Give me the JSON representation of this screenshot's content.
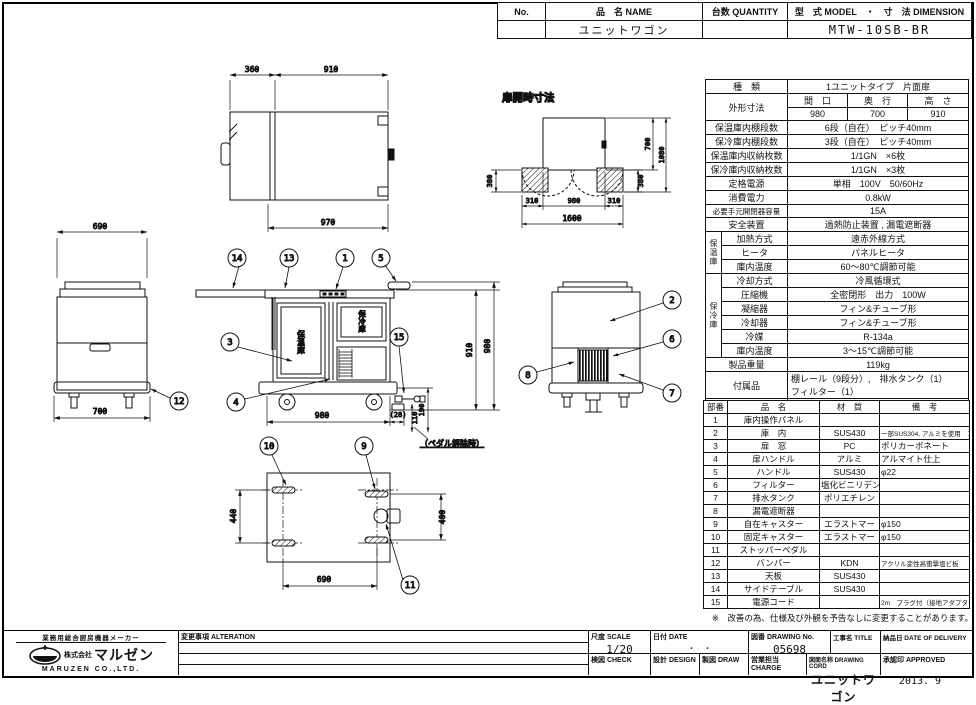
{
  "sheet": {
    "header": {
      "no_label": "No.",
      "name_label": "品　名 NAME",
      "qty_label": "台数 QUANTITY",
      "model_label": "型　式 MODEL　・　寸　法 DIMENSION",
      "name_value": "ユニットワゴン",
      "model_value": "MTW-10SB-BR"
    },
    "disclaimer": "※　改善の為、仕様及び外観を予告なしに変更することがあります。",
    "issue_date": "2013. 9"
  },
  "spec": {
    "kind_label": "種　類",
    "kind_value": "1ユニットタイプ　片面扉",
    "outer_dim_label": "外形寸法",
    "width_label": "間　口",
    "depth_label": "奥　行",
    "height_label": "高　さ",
    "width_value": "980",
    "depth_value": "700",
    "height_value": "910",
    "warm_shelf_label": "保温庫内棚段数",
    "warm_shelf_value": "6段（自在）　ピッチ40mm",
    "cold_shelf_label": "保冷庫内棚段数",
    "cold_shelf_value": "3段（自在）　ピッチ40mm",
    "warm_cap_label": "保温庫内収納枚数",
    "warm_cap_value": "1/1GN　×6枚",
    "cold_cap_label": "保冷庫内収納枚数",
    "cold_cap_value": "1/1GN　×3枚",
    "power_label": "定格電源",
    "power_value": "単相　100V　50/60Hz",
    "consumption_label": "消費電力",
    "consumption_value": "0.8kW",
    "breaker_label": "必要手元開閉器容量",
    "breaker_value": "15A",
    "safety_label": "安全装置",
    "safety_value": "過熱防止装置 , 漏電遮断器",
    "warm_group_label": "保温庫",
    "heat_method_label": "加熱方式",
    "heat_method_value": "遠赤外線方式",
    "heater_label": "ヒータ",
    "heater_value": "パネルヒータ",
    "warm_temp_label": "庫内温度",
    "warm_temp_value": "60〜80℃調節可能",
    "cold_group_label": "保冷庫",
    "cool_method_label": "冷却方式",
    "cool_method_value": "冷風循環式",
    "compressor_label": "圧縮機",
    "compressor_value": "全密閉形　出力　100W",
    "condenser_label": "凝縮器",
    "condenser_value": "フィン&チューブ形",
    "cooler_label": "冷却器",
    "cooler_value": "フィン&チューブ形",
    "refrigerant_label": "冷媒",
    "refrigerant_value": "R-134a",
    "cold_temp_label": "庫内温度",
    "cold_temp_value": "3〜15℃調節可能",
    "weight_label": "製品重量",
    "weight_value": "119kg",
    "accessory_label": "付属品",
    "accessory_value_1": "棚レール（9段分）,　排水タンク（1）",
    "accessory_value_2": "フィルター（1）",
    "condition_label": "使用条件",
    "condition_value_1": "周囲温度：5〜35℃",
    "condition_value_2": "電圧変動：定格電圧の±10%以内"
  },
  "parts": {
    "no_h": "部番",
    "name_h": "品　名",
    "mat_h": "材　質",
    "note_h": "備　考",
    "rows": [
      {
        "no": "1",
        "name": "庫内操作パネル",
        "mat": "",
        "note": ""
      },
      {
        "no": "2",
        "name": "庫　内",
        "mat": "SUS430",
        "note": "一部SUS304, アルミを使用　コーナー部R加工"
      },
      {
        "no": "3",
        "name": "扉　窓",
        "mat": "PC",
        "note": "ポリカーボネート"
      },
      {
        "no": "4",
        "name": "扉ハンドル",
        "mat": "アルミ",
        "note": "アルマイト仕上"
      },
      {
        "no": "5",
        "name": "ハンドル",
        "mat": "SUS430",
        "note": "φ22"
      },
      {
        "no": "6",
        "name": "フィルター",
        "mat": "塩化ビニリデン",
        "note": ""
      },
      {
        "no": "7",
        "name": "排水タンク",
        "mat": "ポリエチレン",
        "note": ""
      },
      {
        "no": "8",
        "name": "漏電遮断器",
        "mat": "",
        "note": ""
      },
      {
        "no": "9",
        "name": "自在キャスター",
        "mat": "エラストマー",
        "note": "φ150"
      },
      {
        "no": "10",
        "name": "固定キャスター",
        "mat": "エラストマー",
        "note": "φ150"
      },
      {
        "no": "11",
        "name": "ストッパーペダル",
        "mat": "",
        "note": ""
      },
      {
        "no": "12",
        "name": "バンパー",
        "mat": "KDN",
        "note": "アクリル変性高衝撃塩ビ板"
      },
      {
        "no": "13",
        "name": "天板",
        "mat": "SUS430",
        "note": ""
      },
      {
        "no": "14",
        "name": "サイドテーブル",
        "mat": "SUS430",
        "note": ""
      },
      {
        "no": "15",
        "name": "電源コード",
        "mat": "",
        "note": "2m　プラグ付（接地アダプター付）"
      }
    ]
  },
  "tblock": {
    "maker_tagline": "業務用総合厨房機器メーカー",
    "company_prefix": "株式会社",
    "company_logo_text": "マルゼン",
    "company_en": "MARUZEN  CO.,LTD.",
    "alteration_label": "変更事項  ALTERATION",
    "scale_label": "尺度  SCALE",
    "scale_value": "1/20",
    "date_label": "日付  DATE",
    "date_value": "・　・",
    "drawing_no_label": "図番  DRAWING No.",
    "drawing_no_value": "05698",
    "title_label": "工事名  TITLE",
    "delivery_label": "納品日  DATE OF DELIVERY",
    "check_label": "検図  CHECK",
    "design_label": "設計  DESIGN",
    "draw_label": "製図  DRAW",
    "charge_label": "営業担当 CHARGE",
    "drawing_name_label": "図面名称  DRAWING CORD",
    "drawing_name_value": "ユニットワゴン",
    "approved_label": "承認印  APPROVED"
  },
  "views": {
    "plan": {
      "d360": "360",
      "d910": "910",
      "d970": "970"
    },
    "door_open": {
      "title": "扉開時寸法",
      "d700": "700",
      "d1080": "1080",
      "d380l": "380",
      "d380r": "380",
      "d310l": "310",
      "d980": "980",
      "d310r": "310",
      "d1600": "1600"
    },
    "front": {
      "warm": "保温庫",
      "cold": "保冷庫",
      "d910": "910",
      "d980v": "980",
      "d980h": "980",
      "d28": "(28)",
      "d110": "110",
      "d190": "190",
      "note": "（ペダル解除時）"
    },
    "left_side": {
      "d690": "690",
      "d700": "700"
    },
    "bottom": {
      "d440": "440",
      "d400": "400",
      "d690": "690"
    },
    "balloons": {
      "b1": "1",
      "b2": "2",
      "b3": "3",
      "b4": "4",
      "b5": "5",
      "b6": "6",
      "b7": "7",
      "b8": "8",
      "b9": "9",
      "b10": "10",
      "b11": "11",
      "b12": "12",
      "b13": "13",
      "b14": "14",
      "b15": "15"
    }
  }
}
